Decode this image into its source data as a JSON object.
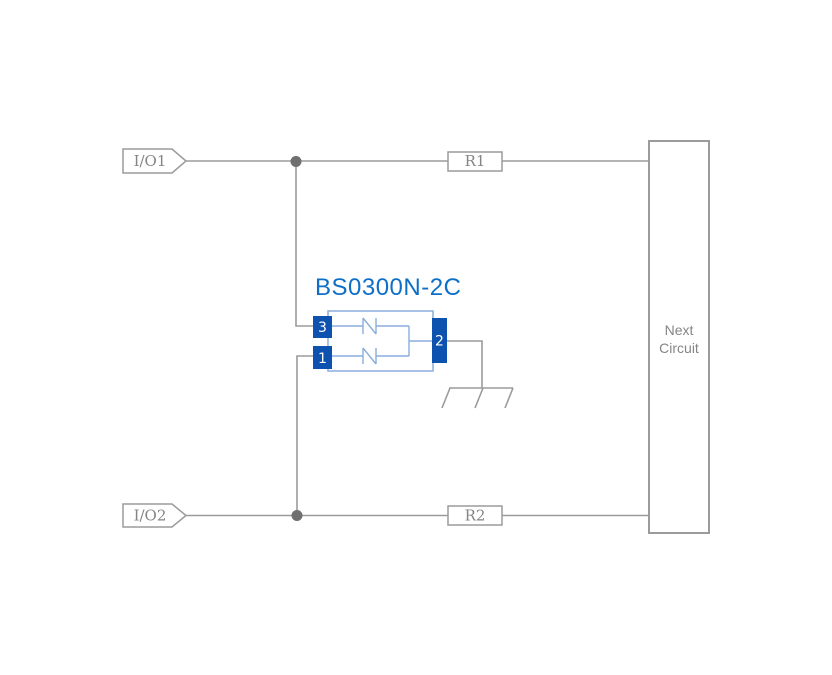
{
  "diagram": {
    "component": {
      "title": "BS0300N-2C",
      "pin3": "3",
      "pin1": "1",
      "pin2": "2"
    },
    "io_ports": [
      {
        "label": "I/O1"
      },
      {
        "label": "I/O2"
      }
    ],
    "resistors": [
      {
        "label": "R1"
      },
      {
        "label": "R2"
      }
    ],
    "next_circuit": {
      "line1": "Next",
      "line2": "Circuit"
    },
    "colors": {
      "background": "#ffffff",
      "wire": "#9b9b9b",
      "junction": "#6f6f6f",
      "text_gray": "#858585",
      "title_blue": "#0e6fc8",
      "pin_blue": "#0d52ae",
      "body_blue": "#8aaede",
      "pin_text": "#ffffff"
    }
  }
}
